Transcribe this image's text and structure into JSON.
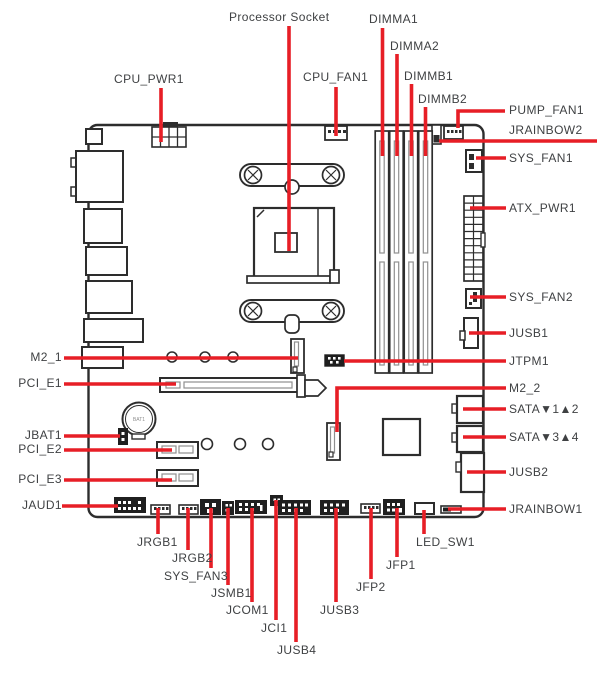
{
  "diagram": {
    "type": "motherboard-layout",
    "colors": {
      "leader_line": "#e71e26",
      "label_text": "#3f4143",
      "drawing_line": "#2d2d2d"
    }
  },
  "labels": {
    "processor_socket": "Processor Socket",
    "dimma1": "DIMMA1",
    "dimma2": "DIMMA2",
    "dimmb1": "DIMMB1",
    "dimmb2": "DIMMB2",
    "cpu_pwr1": "CPU_PWR1",
    "cpu_fan1": "CPU_FAN1",
    "pump_fan1": "PUMP_FAN1",
    "jrainbow2": "JRAINBOW2",
    "sys_fan1": "SYS_FAN1",
    "atx_pwr1": "ATX_PWR1",
    "sys_fan2": "SYS_FAN2",
    "jusb1": "JUSB1",
    "jtpm1": "JTPM1",
    "m2_2": "M2_2",
    "sata_12": "SATA▼1▲2",
    "sata_34": "SATA▼3▲4",
    "jusb2": "JUSB2",
    "jrainbow1": "JRAINBOW1",
    "m2_1": "M2_1",
    "pci_e1": "PCI_E1",
    "jbat1": "JBAT1",
    "pci_e2": "PCI_E2",
    "pci_e3": "PCI_E3",
    "jaud1": "JAUD1",
    "jrgb1": "JRGB1",
    "jrgb2": "JRGB2",
    "sys_fan3": "SYS_FAN3",
    "jsmb1": "JSMB1",
    "jcom1": "JCOM1",
    "jci1": "JCI1",
    "jusb4": "JUSB4",
    "jusb3": "JUSB3",
    "jfp2": "JFP2",
    "jfp1": "JFP1",
    "led_sw1": "LED_SW1",
    "battery": "BAT1"
  }
}
